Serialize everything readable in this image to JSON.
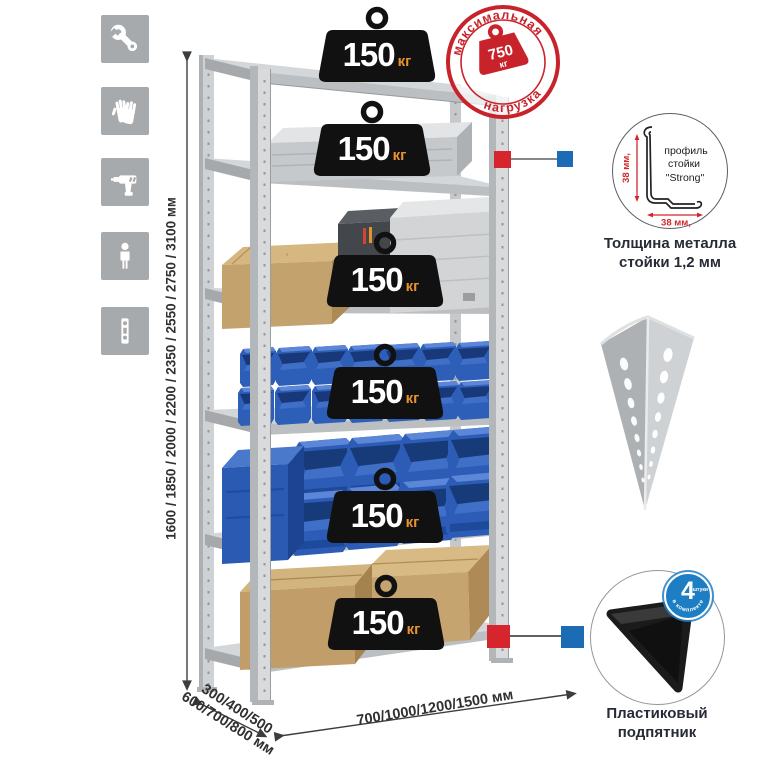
{
  "sidebar": {
    "icons": [
      {
        "name": "wrench-icon"
      },
      {
        "name": "gloves-icon"
      },
      {
        "name": "drill-icon"
      },
      {
        "name": "person-icon"
      },
      {
        "name": "level-icon"
      }
    ]
  },
  "dimensions": {
    "height": "1600 / 1850 / 2000 / 2200 / 2350 / 2550 / 2750 / 3100 мм",
    "depth_line1": "300/400/500",
    "depth_line2": "600/700/800 мм",
    "width": "700/1000/1200/1500 мм"
  },
  "max_load_stamp": {
    "arc_top": "максимальная",
    "arc_bottom": "нагрузка",
    "value": "750",
    "unit": "кг"
  },
  "shelves": [
    {
      "capacity": "150",
      "unit": "кг"
    },
    {
      "capacity": "150",
      "unit": "кг"
    },
    {
      "capacity": "150",
      "unit": "кг"
    },
    {
      "capacity": "150",
      "unit": "кг"
    },
    {
      "capacity": "150",
      "unit": "кг"
    },
    {
      "capacity": "150",
      "unit": "кг"
    }
  ],
  "profile_detail": {
    "label_line1": "профиль",
    "label_line2": "стойки",
    "label_line3": "\"Strong\"",
    "dim_vertical": "38 мм,",
    "dim_horizontal": "38 мм,",
    "caption_line1": "Толщина металла",
    "caption_line2": "стойки 1,2 мм"
  },
  "foot_detail": {
    "badge_value": "4",
    "badge_unit": "штуки",
    "badge_arc": "в комплекте",
    "caption_line1": "Пластиковый",
    "caption_line2": "подпятник"
  },
  "colors": {
    "accent_red": "#c8232b",
    "accent_blue": "#1c6cb5",
    "bin_blue": "#2e5fb8",
    "badge_black": "#111111",
    "kg_orange": "#e8922d",
    "metal_gray": "#d6d8da",
    "icon_gray": "#a7aaac",
    "text_dark": "#272b36"
  }
}
